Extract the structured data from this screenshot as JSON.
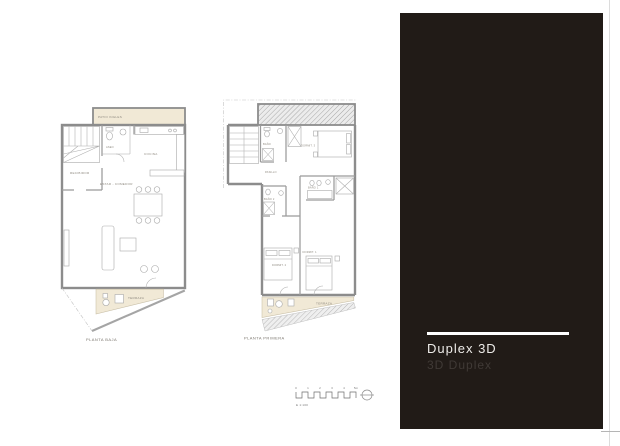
{
  "colors": {
    "page_bg": "#ffffff",
    "panel_bg": "#211b17",
    "accent_beige": "#f1e9d6",
    "wall_gray": "#8c8c8c",
    "label_gray": "#8f8a80"
  },
  "panel": {
    "title": "Duplex 3D",
    "subtitle": "3D Duplex"
  },
  "plans": [
    {
      "id": "planta-baja",
      "caption": "PLANTA BAJA",
      "rooms": {
        "patio": "PATIO INGLES",
        "recibidor": "RECIBIDOR",
        "aseo": "ASEO",
        "cocina": "COCINA",
        "estar": "ESTAR - COMEDOR",
        "terraza": "TERRAZA"
      }
    },
    {
      "id": "planta-primera",
      "caption": "PLANTA PRIMERA",
      "rooms": {
        "banyo": "BAÑO",
        "dormit3": "DORMIT. 3",
        "pasillo": "PASILLO",
        "banyo2": "BAÑO 2",
        "banyo1": "BAÑO 1",
        "dormit2": "DORMIT. 2",
        "dormit1": "DORMIT. 1",
        "terraza": "TERRAZA"
      }
    }
  ],
  "scale_bar": {
    "ticks": [
      "0",
      "1",
      "2",
      "3",
      "4",
      "5m"
    ],
    "label": "E 1:100"
  }
}
